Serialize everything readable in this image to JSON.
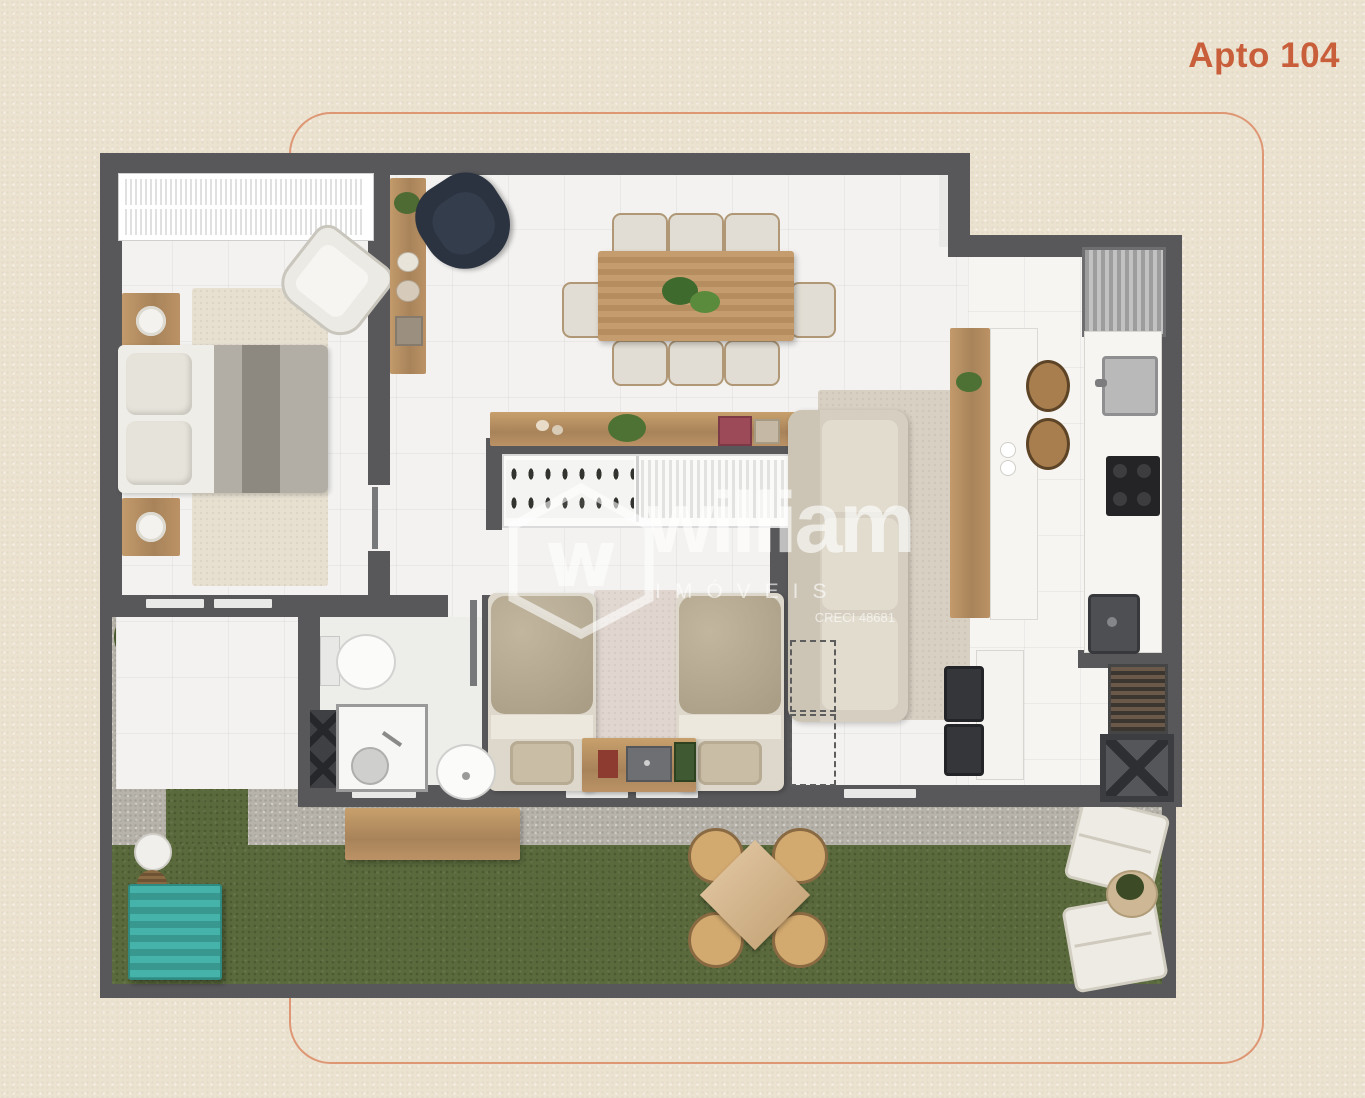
{
  "title": {
    "text": "Apto 104",
    "color": "#c85f3a"
  },
  "frame": {
    "border_color": "#de9774"
  },
  "watermark": {
    "brand": "william",
    "category": "IMÓVEIS",
    "license": "CRECI 48681",
    "logo": "hexagon-w-logo"
  },
  "palette": {
    "background": "#ece2d0",
    "wall": "#58585a",
    "floor": "#f3f2f0",
    "wood": "#b98e5f",
    "grass": "#5a6a3c",
    "gravel": "#b7b3aa",
    "rug": "#d8d0c2",
    "bed_beige": "#b7ab93",
    "sofa": "#d6cfc1",
    "dark_chair": "#2b3340",
    "teal_chest": "#3fa8a0"
  },
  "plan": {
    "rooms": [
      {
        "id": "bedroom-1",
        "furniture": [
          "wardrobe",
          "double-bed",
          "pillows",
          "nightstand",
          "table-lamp",
          "armchair",
          "rug"
        ]
      },
      {
        "id": "entry-hall",
        "furniture": [
          "console-shelf",
          "accent-armchair",
          "decor-plant"
        ]
      },
      {
        "id": "dining-room",
        "furniture": [
          "dining-table",
          "dining-chairs-x8",
          "centerpiece-plant",
          "sideboard"
        ]
      },
      {
        "id": "living-room",
        "furniture": [
          "sofa",
          "area-rug",
          "projection-dashed-outline"
        ]
      },
      {
        "id": "kitchen",
        "furniture": [
          "refrigerator",
          "island-counter",
          "bar-stools-x2",
          "sink",
          "cooktop",
          "marble-counter"
        ]
      },
      {
        "id": "closet",
        "furniture": [
          "shoe-shelf",
          "hanging-clothes-rail"
        ]
      },
      {
        "id": "bedroom-2",
        "furniture": [
          "single-bed-left",
          "single-bed-right",
          "shared-nightstand",
          "runner-rug",
          "foot-bench"
        ]
      },
      {
        "id": "bathroom",
        "furniture": [
          "toilet",
          "shower-box",
          "round-washbasin",
          "storage-rack"
        ]
      },
      {
        "id": "service-area",
        "furniture": [
          "laundry-sink",
          "counter",
          "stools-x2",
          "utility-shaft",
          "drying-rack"
        ]
      },
      {
        "id": "garden",
        "furniture": [
          "lawn",
          "gravel-path",
          "wood-bench",
          "outdoor-table",
          "outdoor-chairs-x4",
          "sun-loungers-x2",
          "round-planter",
          "storage-chest",
          "shrubs",
          "side-table",
          "basket"
        ]
      }
    ]
  }
}
